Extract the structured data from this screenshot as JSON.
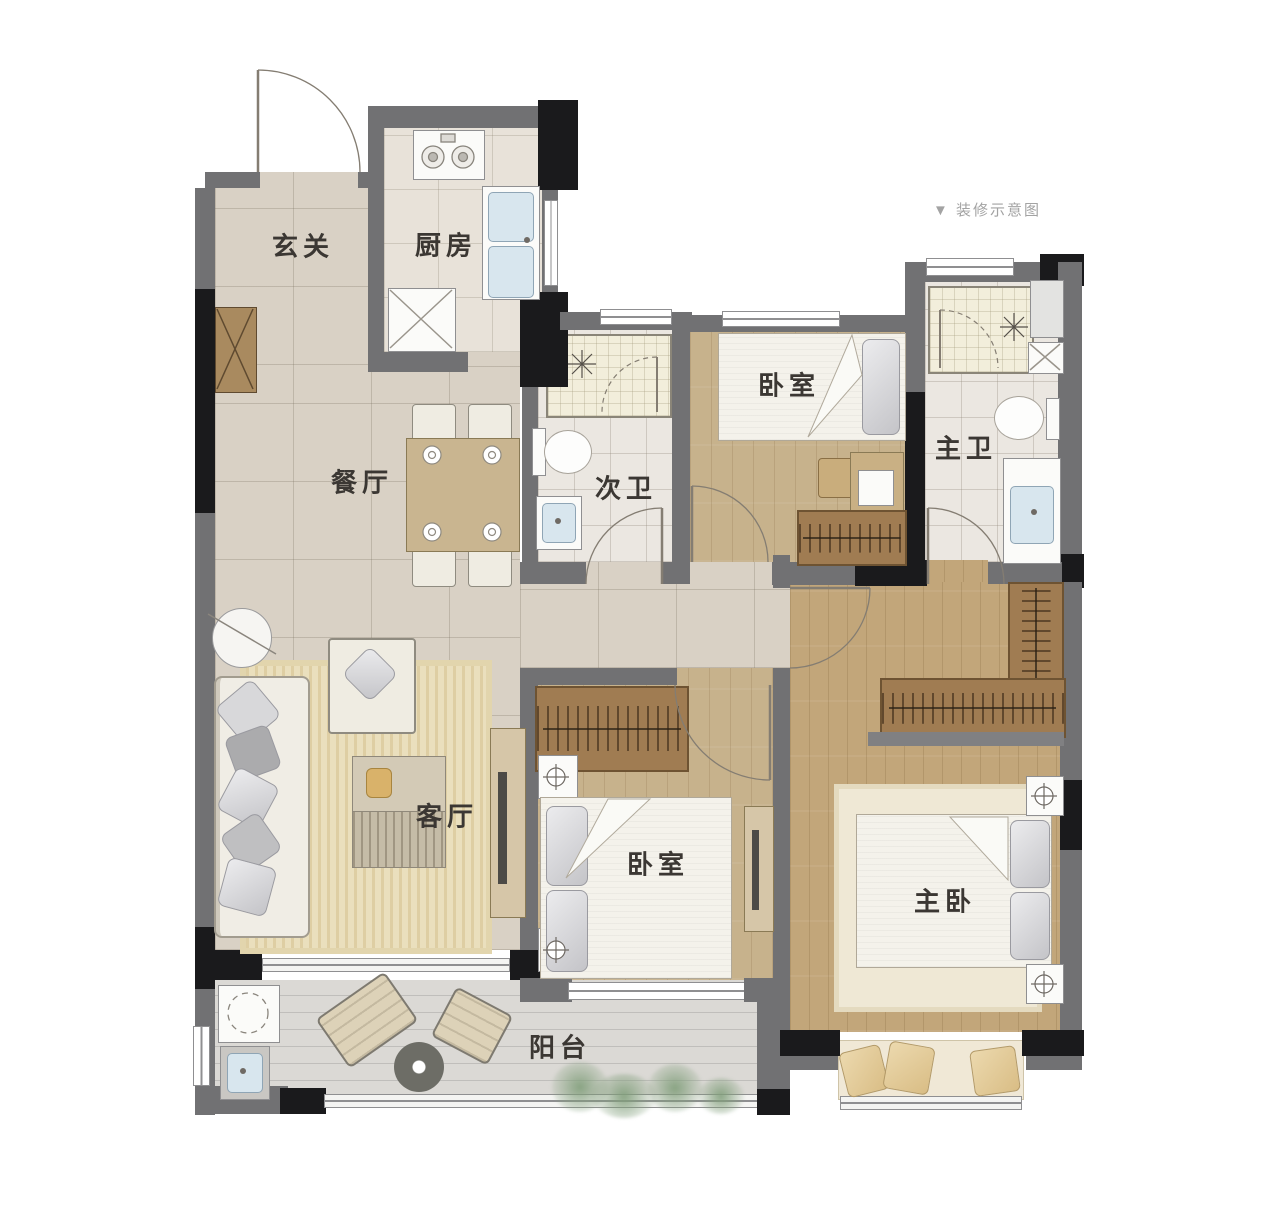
{
  "caption": "▼ 装修示意图",
  "rooms": {
    "foyer": "玄关",
    "kitchen": "厨房",
    "dining": "餐厅",
    "second_bath": "次卫",
    "bedroom_top": "卧室",
    "master_bath": "主卫",
    "living": "客厅",
    "bedroom_mid": "卧室",
    "master_bedroom": "主卧",
    "balcony": "阳台"
  },
  "palette": {
    "wall": "#717173",
    "column": "#1a1a1c",
    "tile_floor": "#d9d1c5",
    "kitchen_floor": "#e8e2d9",
    "bath_floor": "#ebe7e1",
    "shower_floor": "#f2eedb",
    "wood_floor": "#c7b28c",
    "master_wood_floor": "#c2a67a",
    "balcony_floor": "#dbd9d5",
    "wardrobe": "#a07c52",
    "rug": "#eadfbd",
    "sink": "#d8e6ee",
    "label_text": "#3b3733",
    "caption_text": "#a3a3a3"
  }
}
